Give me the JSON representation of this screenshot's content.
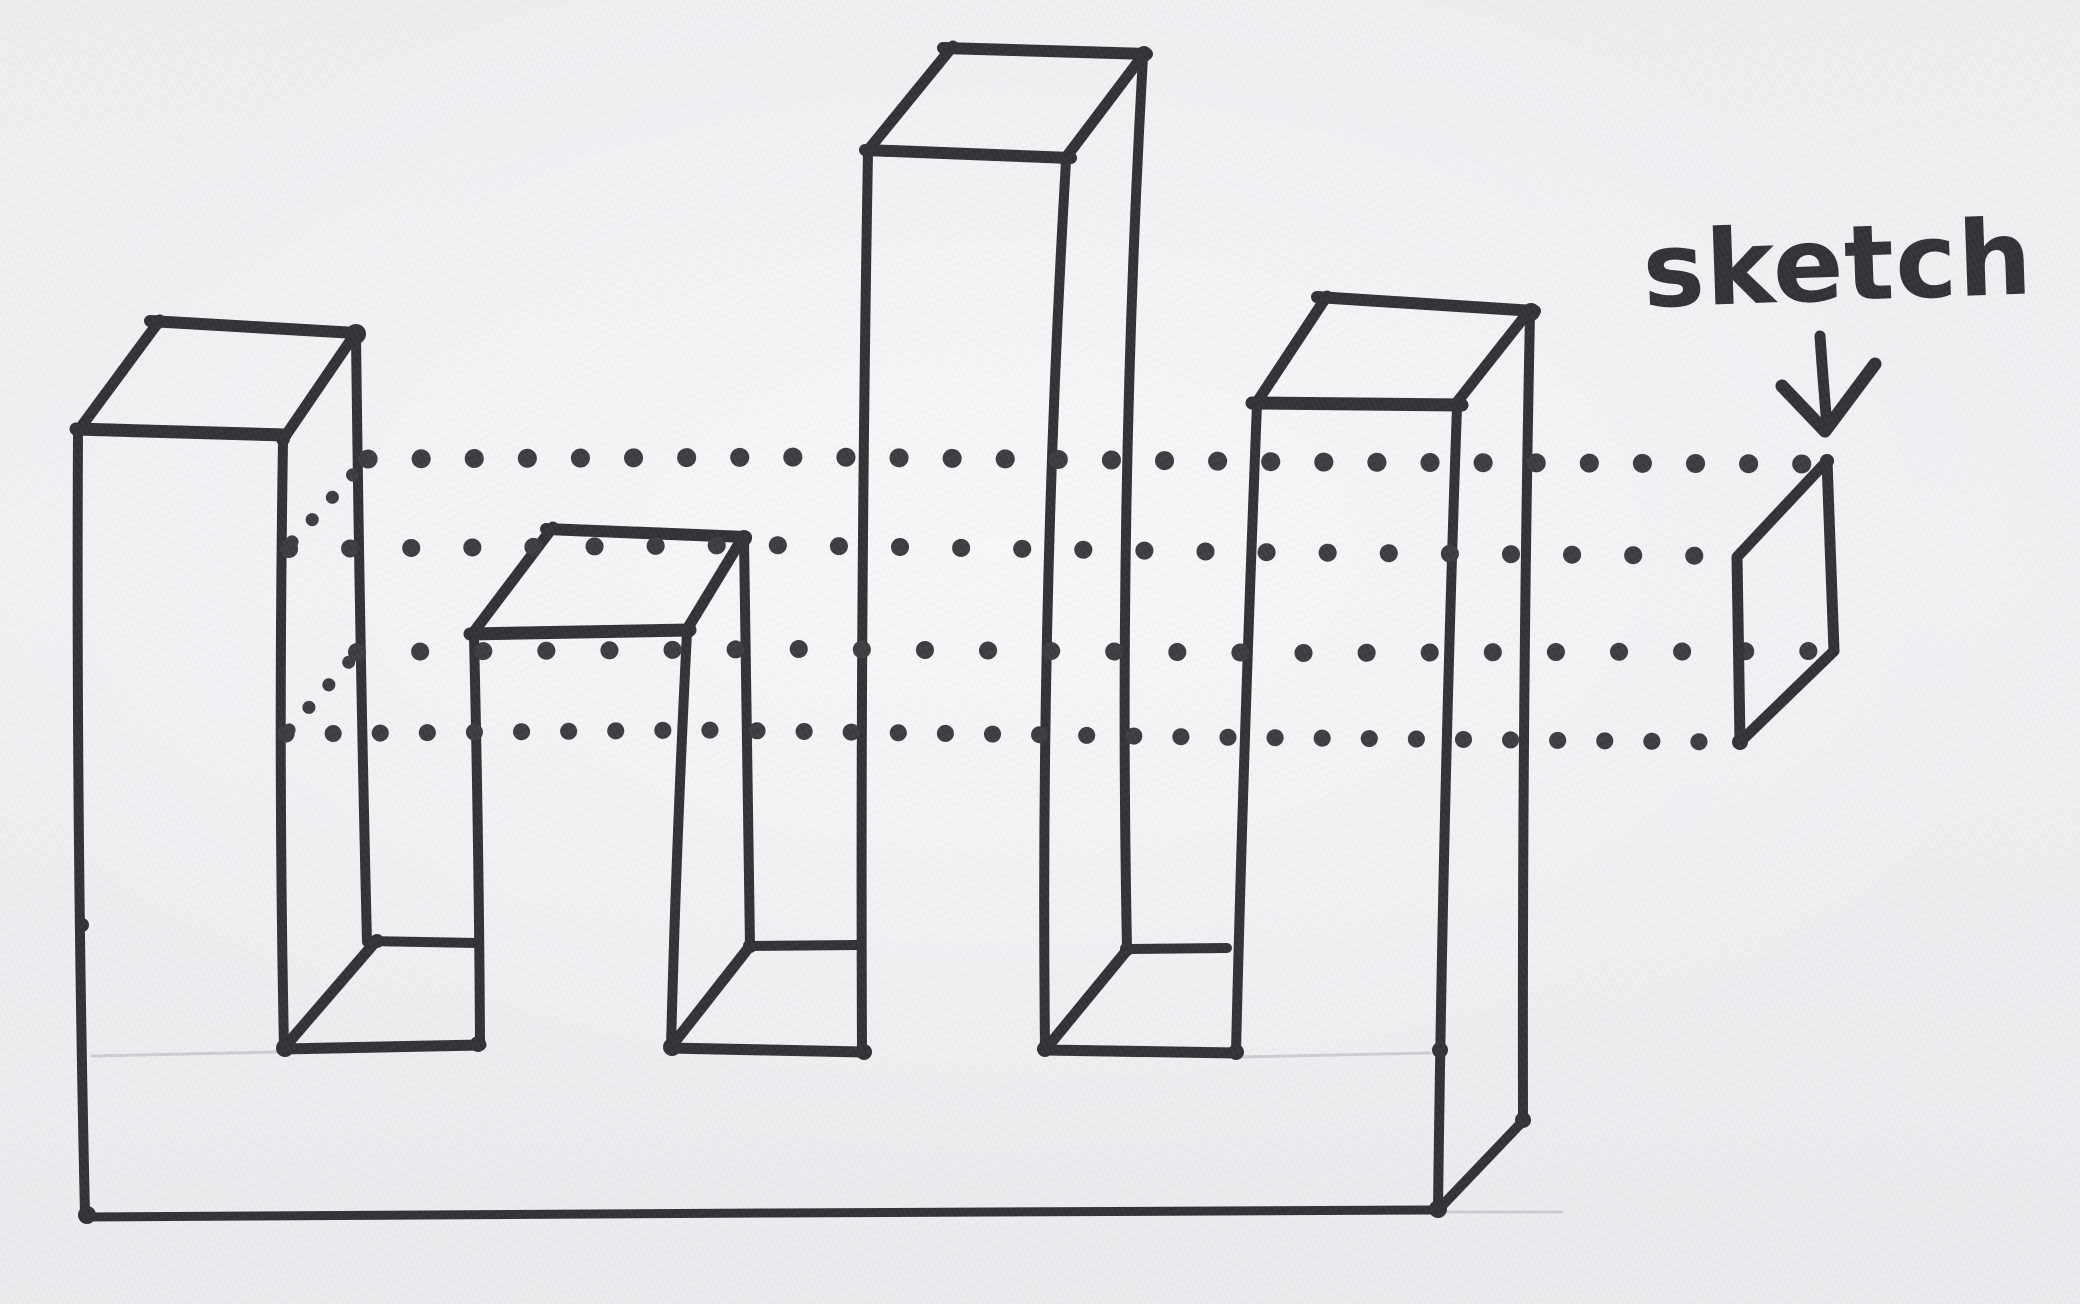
{
  "document": {
    "type": "scanned hand-drawn marker sketch",
    "subject": "Castellated extrusion: four rectangular towers of varying heights on a shared base, with dotted projection lines tracing the four corners of the constant cross-section out to a small parallelogram profile",
    "towers_count": 4,
    "projection_dot_rows": 4,
    "profile_shape": "parallelogram",
    "colors": {
      "paper": "#f1eff2",
      "ink": "#2d2c30",
      "dot_ink": "#38373b",
      "pencil_guide": "#c3c0c6"
    }
  },
  "annotation": {
    "label": "sketch",
    "arrow_icon": "arrow-down-icon"
  }
}
